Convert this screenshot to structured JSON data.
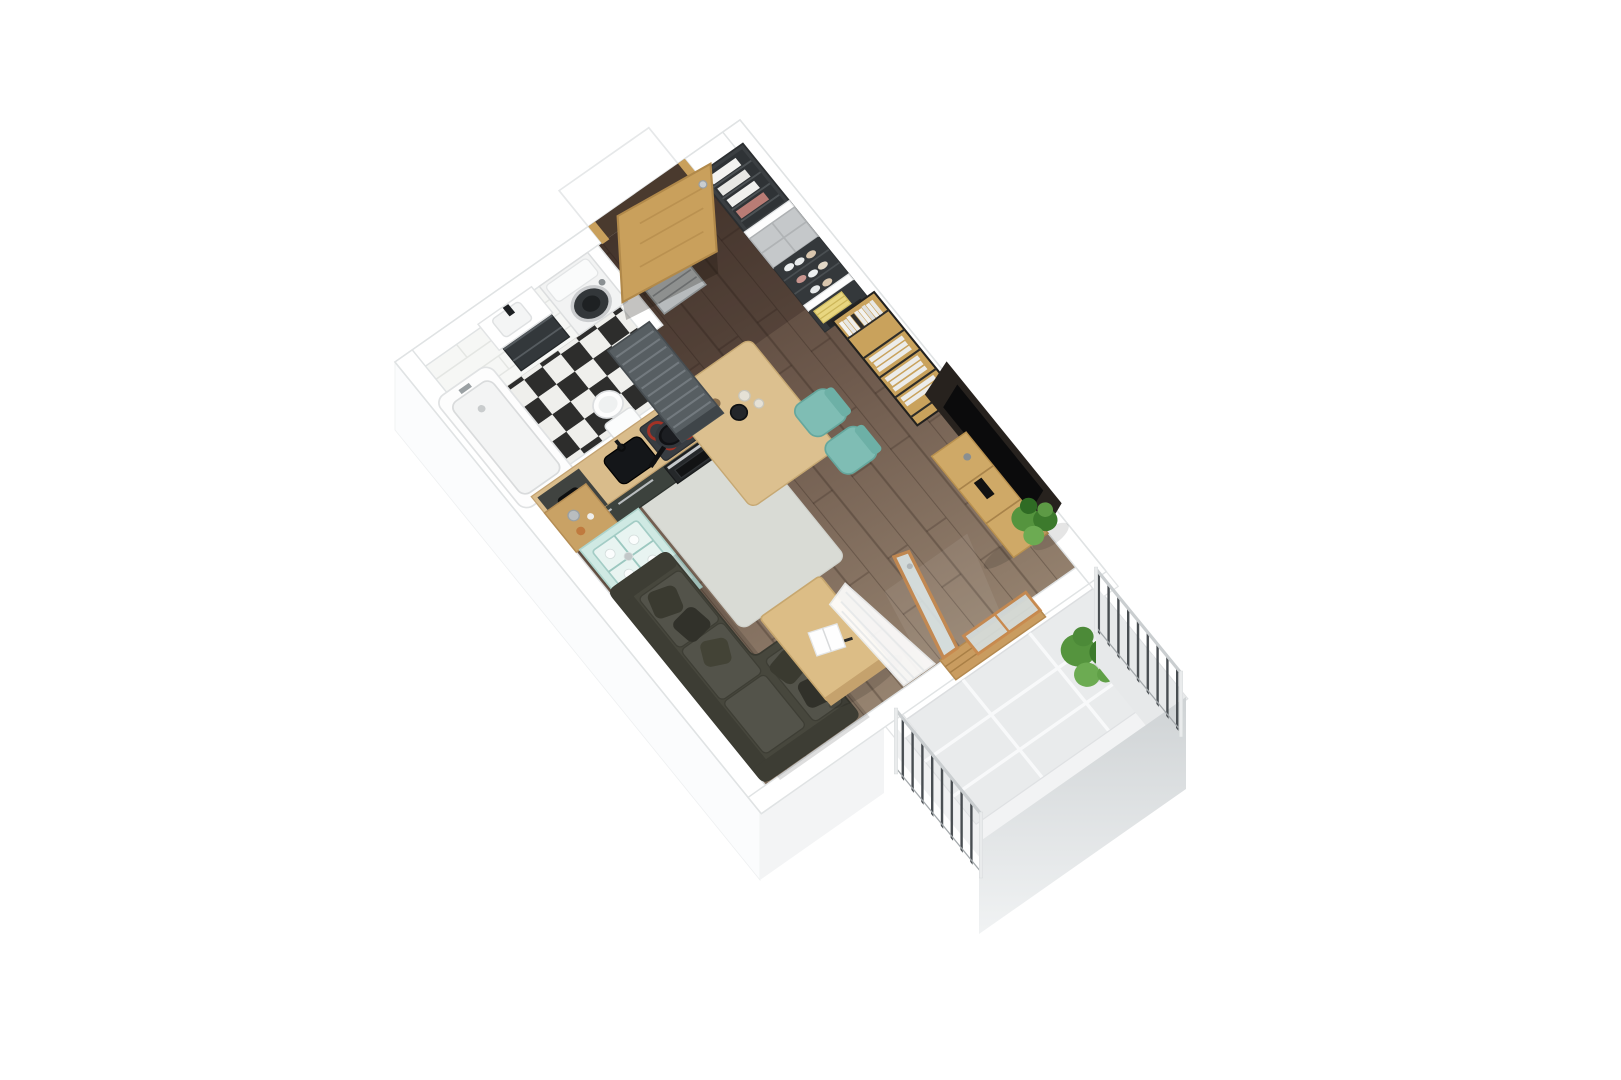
{
  "scene": {
    "type": "3d-floor-plan-axonometric-render",
    "background": "#ffffff",
    "text_visible": "none"
  },
  "rooms": [
    {
      "id": "bathroom",
      "label": "bathroom",
      "floor": "black-white-checker-tile",
      "items": [
        "bathtub",
        "vanity-with-sink",
        "washing-machine",
        "toilet",
        "white-brick-wall"
      ]
    },
    {
      "id": "hallway",
      "label": "entrance-hall",
      "floor": "dark-wood-plank",
      "items": [
        "entrance-door",
        "white-outside-step",
        "open-wardrobe-clothes",
        "closed-grey-wardrobe",
        "open-wardrobe-shoes",
        "wardrobe-towels-boxes",
        "slatted-cabinet",
        "metal-shoe-rack"
      ]
    },
    {
      "id": "kitchen",
      "label": "kitchen",
      "floor": "wood-plank-with-grey-rug",
      "items": [
        "l-shaped-counter",
        "black-sink",
        "cooktop-with-pan",
        "oven",
        "coffee-machine",
        "bar-counter",
        "bar-stool",
        "bar-stool",
        "wood-console",
        "mint-glass-cabinet"
      ]
    },
    {
      "id": "living-room",
      "label": "living-room",
      "floor": "wood-plank",
      "items": [
        "corner-sofa",
        "throw-pillows",
        "coffee-table",
        "magazine",
        "tv-wall-panel",
        "tv",
        "tv-stand",
        "ladder-bookshelf",
        "indoor-plant",
        "sheer-curtain",
        "balcony-door"
      ]
    },
    {
      "id": "balcony",
      "label": "balcony",
      "floor": "light-grey-tile",
      "items": [
        "metal-railing-sw",
        "metal-railing-ne",
        "solid-parapet",
        "balcony-plant",
        "wood-framed-glass-door"
      ]
    }
  ],
  "counts": {
    "bar_stools": 2,
    "throw_pillows": 5,
    "railings": 2,
    "plants": 2
  },
  "colors": {
    "wall": "#ffffff",
    "wall_edge": "#e0e3e4",
    "slab_face": "#f3f4f5",
    "floor_dark": "#4e3d33",
    "floor_mid": "#6d594c",
    "floor_light": "#95826f",
    "checker_dark": "#2d2d2c",
    "checker_light": "#efefec",
    "brick": "#f6f7f5",
    "tub": "#fdfdfd",
    "vanity": "#33383b",
    "washer": "#f2f3f3",
    "washer_door": "#33373a",
    "cabinet": "#3c423d",
    "counter_wood": "#d9bc8b",
    "bar_wood": "#dcc08f",
    "bar_base": "#313733",
    "sink": "#141619",
    "cooktop": "#383d42",
    "burner": "#a33226",
    "oven": "#25282a",
    "stool": "#7fbdb4",
    "console_wood": "#c9a265",
    "mint": "#cfe9e3",
    "mint_glass": "#edf7f4",
    "rug": "#d9dbd5",
    "sofa": "#47473d",
    "sofa_back": "#3d3d34",
    "cushion": "#53534a",
    "pillow": "#35352c",
    "table": "#dcbd86",
    "tv_panel": "#27221e",
    "tv": "#0b0b0c",
    "stand": "#cfa967",
    "shelf": "#c9a25c",
    "books": "#f0f0ee",
    "wardrobe": "#3b3f42",
    "wardrobe_door": "#c5c8ca",
    "towel": "#e8d680",
    "slat": "#575e62",
    "rack": "#b7bbbd",
    "door_wood": "#c9a05c",
    "frame_orange": "#c98a4e",
    "glass": "#d6dfe0",
    "balcony_tile": "#e9ebec",
    "grout": "#f8f9fa",
    "parapet_top": "#cfd3d5",
    "parapet_bottom": "#f0f2f3",
    "rail": "#caced0",
    "baluster": "#484d51",
    "post": "#e9ebec",
    "plant": "#55943e",
    "plant_dark": "#3c7a2c",
    "plant_light": "#6cab52",
    "curtain": "#ffffff"
  }
}
